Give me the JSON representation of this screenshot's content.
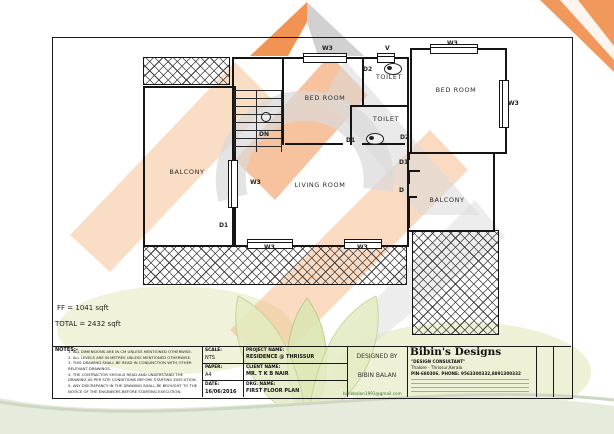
{
  "colors": {
    "wall": "#151515",
    "accent_orange": "#ef8740",
    "accent_orange_light": "#f7cba6",
    "accent_gray": "#d9d9d9",
    "leaf_green_light": "#dce6b2",
    "leaf_green_edge": "#b5c878",
    "band_green": "#e6ecdc",
    "blob_green": "#f0f2da",
    "email_green": "#3c6e32"
  },
  "plan": {
    "rooms": [
      {
        "label": "BALCONY"
      },
      {
        "label": "BED ROOM"
      },
      {
        "label": "LIVING ROOM"
      },
      {
        "label": "TOILET"
      },
      {
        "label": "TOILET"
      },
      {
        "label": "BED ROOM"
      },
      {
        "label": "BALCONY"
      }
    ],
    "tags": [
      {
        "text": "W3"
      },
      {
        "text": "V"
      },
      {
        "text": "W3"
      },
      {
        "text": "W3"
      },
      {
        "text": "D2"
      },
      {
        "text": "D2"
      },
      {
        "text": "D1"
      },
      {
        "text": "D1"
      },
      {
        "text": "D"
      },
      {
        "text": "W3"
      },
      {
        "text": "D1"
      },
      {
        "text": "W3"
      },
      {
        "text": "W3"
      },
      {
        "text": "DN"
      }
    ],
    "areas": {
      "ff": "FF = 1041 sqft",
      "total": "TOTAL = 2432 sqft"
    }
  },
  "title_block": {
    "notes": {
      "heading": "NOTES:-",
      "items": [
        "1. ALL DIMENSIONS ARE IN CM UNLESS MENTIONED OTHERWISE.",
        "2. ALL LEVELS ARE IN METRES UNLESS MENTIONED OTHERWISE.",
        "3. THIS DRAWING SHALL BE READ IN CONJUNCTION WITH OTHER RELEVANT DRAWINGS.",
        "4. THE CONTRACTOR SHOULD READ AND UNDERSTAND THE DRAWING AS PER SITE CONDITIONS BEFORE STARTING EXECUTION.",
        "5. ANY DISCREPANCY IN THE DRAWING SHALL BE BROUGHT TO THE NOTICE OF THE ENGINEERS BEFORE STARTING EXECUTION."
      ]
    },
    "scale_label": "SCALE:",
    "scale_value": "NTS",
    "paper_label": "PAPER:",
    "paper_value": "A4",
    "date_label": "DATE:",
    "date_value": "16/06/2016",
    "project_label": "PROJECT NAME:",
    "project_value": "RESIDENCE @ THRISSUR",
    "client_label": "CLIENT NAME:",
    "client_value": "MR. T K B NAIR",
    "drg_label": "DRG. NAME:",
    "drg_value": "FIRST FLOOR PLAN",
    "designed_by_label": "DESIGNED BY",
    "designed_by_value": "BIBIN BALAN",
    "firm": {
      "name": "Bibin's Designs",
      "tagline": "\"DESIGN CONSULTANT\"",
      "address": "Thalore - Thrissur,Kerala",
      "pin_phone": "PIN-680306. PHONE: 9563300332,8891300332",
      "email": "bibinbalan1991@gmail.com"
    }
  }
}
